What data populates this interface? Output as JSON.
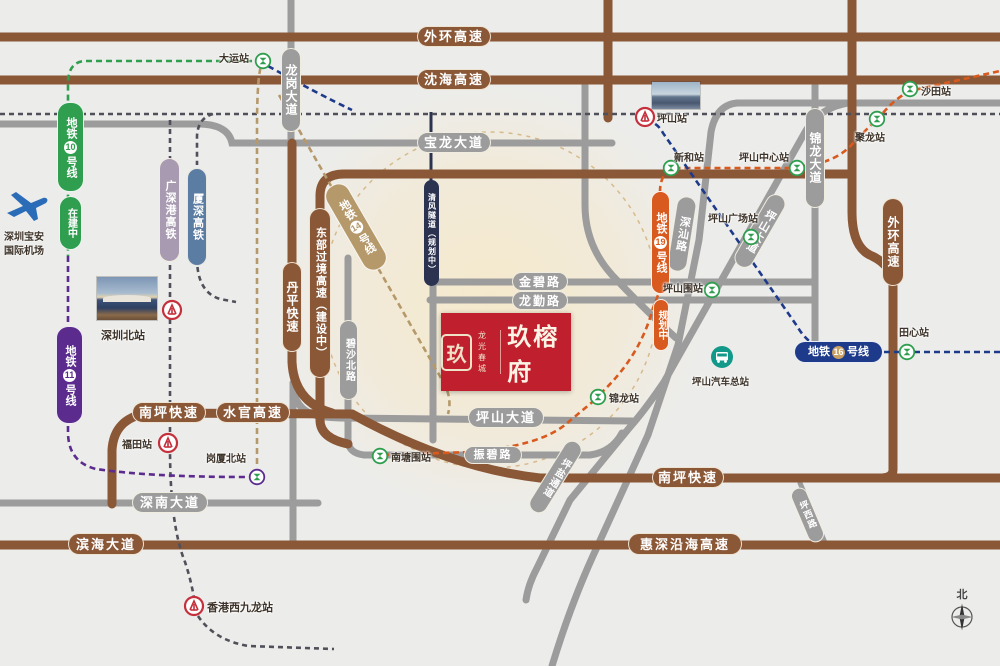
{
  "project_logo": {
    "brand_top": "龙光",
    "brand_bottom": "春城",
    "name": "玖榕府",
    "seal_char": "玖"
  },
  "compass": {
    "north_label": "北"
  },
  "pois": {
    "bus_station": "坪山汽车总站",
    "airport_line1": "深圳宝安",
    "airport_line2": "国际机场"
  },
  "colors": {
    "background": "#ececea",
    "highway_brown": "#8a5737",
    "road_gray": "#9c9c9c",
    "tunnel_navy": "#2b3350",
    "metro10_green": "#2f9e4f",
    "metro11_purple": "#5b2c8e",
    "metro14_tan": "#b5996b",
    "metro16_navy": "#1e3a8a",
    "metro19_orange": "#d85a1e",
    "rail_gsg": "#a89ab0",
    "rail_xiashen": "#5b7ca3",
    "rail_dash": "#50505a",
    "logo_red": "#c01f2e",
    "rail_icon_red": "#c4303c",
    "bus_teal": "#12998a",
    "glow_cream": "#f6e9cb"
  },
  "road_labels": [
    {
      "id": "waihuan-top",
      "text": "外环高速",
      "kind": "brown",
      "box": [
        417,
        26,
        74,
        21
      ]
    },
    {
      "id": "shenhai",
      "text": "沈海高速",
      "kind": "brown",
      "box": [
        417,
        69,
        74,
        21
      ]
    },
    {
      "id": "baolong",
      "text": "宝龙大道",
      "kind": "gray",
      "box": [
        417,
        132,
        74,
        21
      ]
    },
    {
      "id": "longgang",
      "text": "龙岗大道",
      "kind": "gray",
      "box": [
        281,
        48,
        20,
        84
      ],
      "vert": true,
      "fs": 12
    },
    {
      "id": "waihuan-right",
      "text": "外环高速",
      "kind": "brown",
      "box": [
        882,
        198,
        22,
        88
      ],
      "vert": true,
      "fs": 12
    },
    {
      "id": "dongbu",
      "text": "东部过境高速（建设中）",
      "kind": "brown",
      "box": [
        309,
        208,
        22,
        170
      ],
      "vert": true,
      "fs": 11
    },
    {
      "id": "danping",
      "text": "丹平快速",
      "kind": "brown",
      "box": [
        282,
        262,
        20,
        90
      ],
      "vert": true,
      "fs": 12
    },
    {
      "id": "qingfeng-tunnel",
      "text": "清风隧道（规划中）",
      "kind": "navyroad",
      "box": [
        424,
        180,
        15,
        106
      ],
      "vert": true,
      "fs": 8
    },
    {
      "id": "jinbi",
      "text": "金碧路",
      "kind": "gray",
      "box": [
        512,
        272,
        56,
        19
      ],
      "fs": 12
    },
    {
      "id": "longqin",
      "text": "龙勤路",
      "kind": "gray",
      "box": [
        512,
        291,
        56,
        19
      ],
      "fs": 12
    },
    {
      "id": "bisha-north",
      "text": "碧沙北路",
      "kind": "gray",
      "box": [
        339,
        320,
        19,
        80
      ],
      "vert": true,
      "fs": 10
    },
    {
      "id": "jinlong-avenue",
      "text": "锦龙大道",
      "kind": "gray",
      "box": [
        805,
        108,
        20,
        100
      ],
      "vert": true,
      "fs": 12
    },
    {
      "id": "shenshan-road",
      "text": "深汕路",
      "kind": "gray",
      "box": [
        672,
        196,
        20,
        76
      ],
      "vert": true,
      "rot": 9,
      "fs": 11
    },
    {
      "id": "pingshan-avenue-diag",
      "text": "坪山大道",
      "kind": "gray",
      "box": [
        750,
        190,
        20,
        82
      ],
      "vert": true,
      "rot": 30,
      "fs": 11
    },
    {
      "id": "pingshan-avenue",
      "text": "坪山大道",
      "kind": "gray",
      "box": [
        468,
        407,
        76,
        21
      ]
    },
    {
      "id": "zhenbi",
      "text": "振碧路",
      "kind": "gray",
      "box": [
        464,
        446,
        58,
        18
      ],
      "fs": 11
    },
    {
      "id": "pingyan",
      "text": "坪盐通道",
      "kind": "gray",
      "box": [
        546,
        436,
        19,
        82
      ],
      "vert": true,
      "rot": 32,
      "fs": 10
    },
    {
      "id": "nanping-west",
      "text": "南坪快速",
      "kind": "brown",
      "box": [
        132,
        402,
        74,
        21
      ]
    },
    {
      "id": "shuiguan",
      "text": "水官高速",
      "kind": "brown",
      "box": [
        216,
        402,
        74,
        21
      ]
    },
    {
      "id": "nanping-east",
      "text": "南坪快速",
      "kind": "brown",
      "box": [
        652,
        467,
        72,
        21
      ]
    },
    {
      "id": "shennan",
      "text": "深南大道",
      "kind": "gray",
      "box": [
        132,
        492,
        76,
        21
      ]
    },
    {
      "id": "binhai",
      "text": "滨海大道",
      "kind": "brown",
      "box": [
        68,
        533,
        76,
        22
      ]
    },
    {
      "id": "huishen-coastal",
      "text": "惠深沿海高速",
      "kind": "brown",
      "box": [
        628,
        533,
        114,
        22
      ]
    },
    {
      "id": "pingxi",
      "text": "坪西路",
      "kind": "gray",
      "box": [
        799,
        486,
        17,
        58
      ],
      "vert": true,
      "rot": -23,
      "fs": 9
    }
  ],
  "metro_labels": [
    {
      "id": "metro-10",
      "prefix": "地铁",
      "number": "10",
      "suffix": "号线",
      "color": "#2f9e4f",
      "box": [
        57,
        102,
        27,
        90
      ],
      "note": "在建中",
      "note_box": [
        59,
        196,
        23,
        54
      ]
    },
    {
      "id": "metro-11",
      "prefix": "地铁",
      "number": "11",
      "suffix": "号线",
      "color": "#5b2c8e",
      "box": [
        56,
        326,
        27,
        98
      ]
    },
    {
      "id": "metro-14",
      "prefix": "地铁",
      "number": "14",
      "suffix": "号线",
      "color": "#b5996b",
      "box": [
        343,
        179,
        26,
        96
      ],
      "rot": -30
    },
    {
      "id": "metro-19",
      "prefix": "地铁",
      "number": "19",
      "suffix": "号线",
      "color": "#d85a1e",
      "box": [
        651,
        191,
        19,
        103
      ],
      "note": "规划中",
      "note_box": [
        653,
        299,
        16,
        52
      ]
    },
    {
      "id": "metro-16",
      "prefix": "地铁",
      "number": "16",
      "suffix": "号线",
      "color": "#1e3a8a",
      "box": [
        794,
        341,
        89,
        22
      ],
      "horizontal": true
    }
  ],
  "rail_labels": [
    {
      "id": "rail-guangshengang",
      "text": "广深港高铁",
      "color": "#a89ab0",
      "box": [
        159,
        158,
        21,
        104
      ]
    },
    {
      "id": "rail-xiashen",
      "text": "厦深高铁",
      "color": "#5b7ca3",
      "box": [
        187,
        168,
        20,
        98
      ]
    }
  ],
  "stations": [
    {
      "name": "大运站",
      "type": "metro",
      "icon": [
        263,
        61
      ],
      "label": [
        219,
        50
      ]
    },
    {
      "name": "沙田站",
      "type": "metro",
      "icon": [
        910,
        89
      ],
      "label": [
        921,
        83
      ]
    },
    {
      "name": "聚龙站",
      "type": "metro",
      "icon": [
        877,
        119
      ],
      "label": [
        855,
        129
      ]
    },
    {
      "name": "新和站",
      "type": "metro",
      "icon": [
        671,
        168
      ],
      "label": [
        674,
        149
      ]
    },
    {
      "name": "坪山中心站",
      "type": "metro",
      "icon": [
        797,
        168
      ],
      "label": [
        739,
        149
      ]
    },
    {
      "name": "坪山广场站",
      "type": "metro",
      "icon": [
        751,
        237
      ],
      "label": [
        708,
        210
      ]
    },
    {
      "name": "坪山围站",
      "type": "metro",
      "icon": [
        712,
        290
      ],
      "label": [
        663,
        280
      ]
    },
    {
      "name": "田心站",
      "type": "metro",
      "icon": [
        907,
        352
      ],
      "label": [
        899,
        324
      ]
    },
    {
      "name": "锦龙站",
      "type": "metro",
      "icon": [
        598,
        397
      ],
      "label": [
        609,
        390
      ]
    },
    {
      "name": "南塘围站",
      "type": "metro",
      "icon": [
        380,
        456
      ],
      "label": [
        391,
        449
      ]
    },
    {
      "name": "岗厦北站",
      "type": "metro",
      "ring": "#5b2c8e",
      "icon": [
        257,
        477
      ],
      "label": [
        206,
        450
      ]
    },
    {
      "name": "坪山站",
      "type": "rail",
      "icon": [
        645,
        117
      ],
      "label": [
        657,
        110
      ]
    },
    {
      "name": "深圳北站",
      "type": "rail",
      "icon": [
        172,
        310
      ],
      "label": [
        101,
        327
      ],
      "fs": 11
    },
    {
      "name": "福田站",
      "type": "rail",
      "icon": [
        168,
        443
      ],
      "label": [
        122,
        436
      ]
    },
    {
      "name": "香港西九龙站",
      "type": "rail",
      "icon": [
        194,
        606
      ],
      "label": [
        207,
        599
      ],
      "fs": 11
    }
  ]
}
